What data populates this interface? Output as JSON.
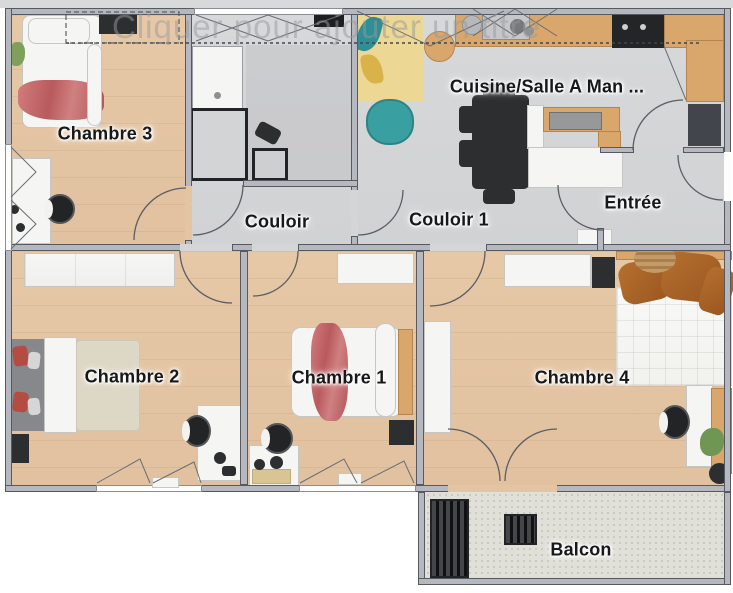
{
  "watermark": {
    "text": "Cliquer pour ajouter un titre"
  },
  "rooms": {
    "chambre3": {
      "label": "Chambre 3"
    },
    "couloir": {
      "label": "Couloir"
    },
    "couloir1": {
      "label": "Couloir 1"
    },
    "cuisine": {
      "label": "Cuisine/Salle A Man ..."
    },
    "entree": {
      "label": "Entrée"
    },
    "chambre2": {
      "label": "Chambre 2"
    },
    "chambre1": {
      "label": "Chambre 1"
    },
    "chambre4": {
      "label": "Chambre 4"
    },
    "balcon": {
      "label": "Balcon"
    }
  },
  "colors": {
    "wood_floor": "#e4c5a3",
    "hard_floor": "#d4d5d7",
    "balcony_floor": "#e1e0d8",
    "wall_fill": "#b5b9bf",
    "wall_stroke": "#565a60",
    "label_text": "#17181a",
    "accent_red_blanket": "#c96a6e",
    "accent_teal_beanbag": "#3a9fa0",
    "wood_counter": "#d9a76b",
    "dark_furniture": "#2d2e30",
    "rust_pillows": "#a8652a",
    "rug_yellow": "#ecd795"
  }
}
